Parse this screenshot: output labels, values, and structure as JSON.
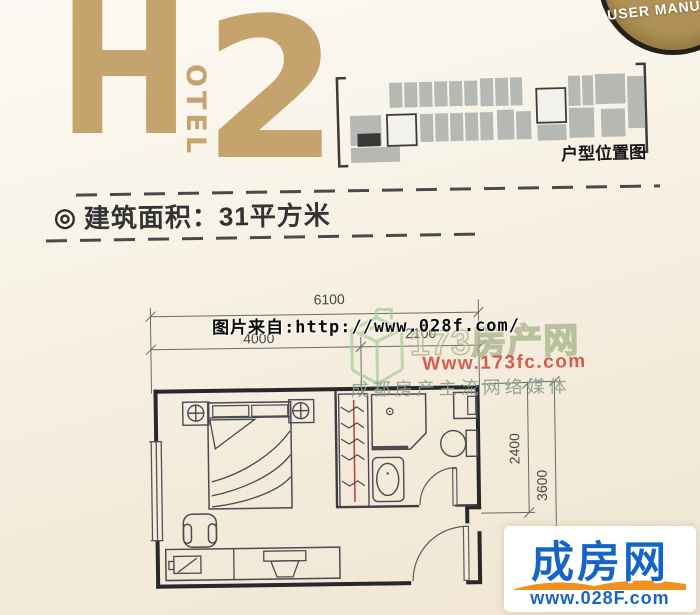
{
  "badge": {
    "label": "USER MANU"
  },
  "logo": {
    "h": "H",
    "otel": "OTEL",
    "num": "2"
  },
  "location": {
    "label": "户型位置图"
  },
  "area": {
    "bullet": "◎",
    "text": "建筑面积：31平方米"
  },
  "plan": {
    "dims": {
      "total_width": "6100",
      "width_left": "4000",
      "width_right": "2100",
      "depth_upper": "2400",
      "depth_total": "3600"
    }
  },
  "watermarks": {
    "photo_source": "图片来自:http://www.028f.com/",
    "site173": {
      "name": "173房产网",
      "url": "Www.173fc.com",
      "slogan": "成都房产主流网络媒体"
    },
    "site028": {
      "name": "成房网",
      "url": "www.028F.com"
    }
  },
  "colors": {
    "brand_tan": "#c4a36c",
    "watermark_red": "#d04a3a",
    "watermark_green": "#a8d098",
    "logo_blue": "#1565c8",
    "logo_orange": "#f09020"
  }
}
